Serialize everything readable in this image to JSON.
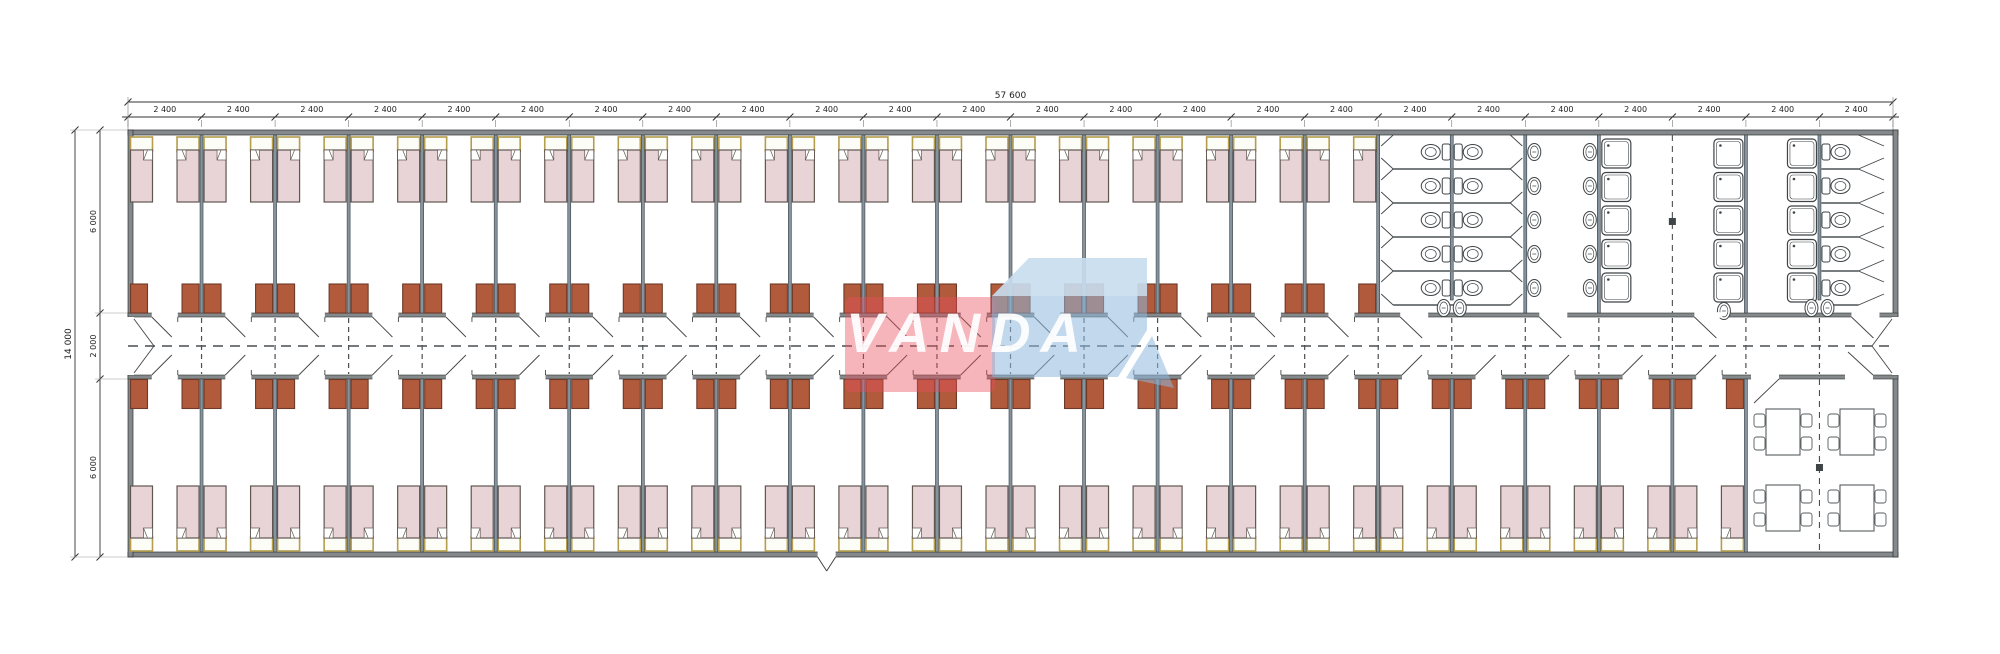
{
  "meta": {
    "drawing_type": "dormitory floor plan"
  },
  "dimensions": {
    "overall_width_label": "57 600",
    "bay_label": "2 400",
    "bay_count": 24,
    "overall_height_label": "14 000",
    "height_segment_labels": [
      "6 000",
      "2 000",
      "6 000"
    ]
  },
  "layout_counts": {
    "top_bedrooms": 17,
    "bottom_bedrooms": 22,
    "beds_per_room": 2,
    "wardrobes_per_room": 2,
    "wc_stall_double_rows": 5,
    "toilets_total": 15,
    "sinks_total": 15,
    "showers_total": 15,
    "dining_tables": 4,
    "chairs_per_table": 4
  },
  "colors": {
    "wall_fill": "#85898b",
    "wall_edge": "#2e3233",
    "partition_fill": "#84939e",
    "partition_edge": "#3b4044",
    "bed_mattress": "#e8d3d7",
    "bed_edge": "#5f564f",
    "headboard_fill": "#fdfdf8",
    "headboard_edge": "#b59d4b",
    "wardrobe_fill": "#b15a3c",
    "wardrobe_edge": "#6e3926",
    "fixture_stroke": "#3f4447",
    "dash_line": "#4a4f52",
    "dim_line": "#333333",
    "dim_text": "#222222"
  },
  "logo": {
    "text": "VANDA",
    "pink": "#e84e5e",
    "blue": "#8fb8dc",
    "blue_light": "#cfe2f1"
  }
}
